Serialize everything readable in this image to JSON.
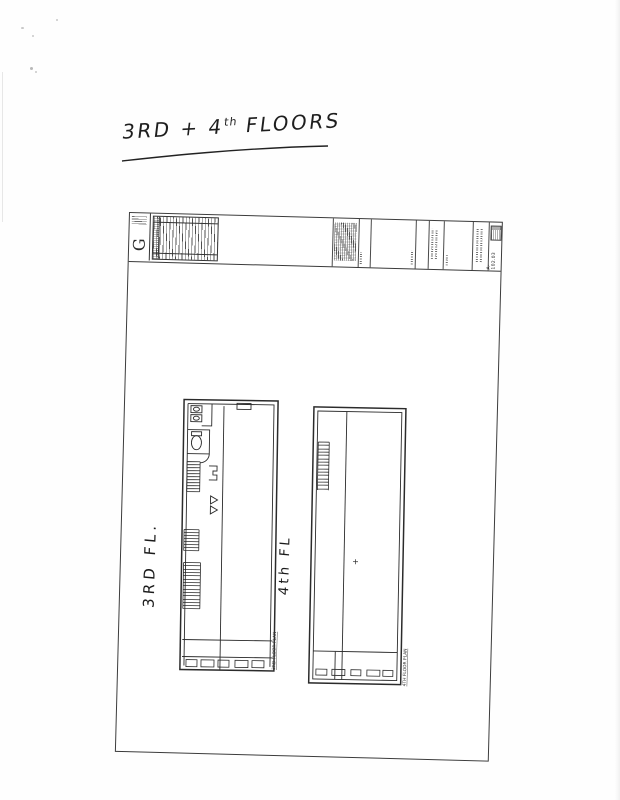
{
  "annotation": {
    "text_main": "3RD + 4",
    "text_sup": "th",
    "text_tail": " FLOORS"
  },
  "handwritten_labels": {
    "left_plan": "3RD FL.",
    "right_plan": "4th FL"
  },
  "title_block": {
    "logo_letter": "G",
    "sheet_number": "A-102.03"
  },
  "plan_captions": {
    "left": "3RD FLOOR PLAN",
    "right": "4TH FLOOR PLAN"
  },
  "colors": {
    "ink": "#222222",
    "line_dark": "#333333",
    "paper": "#ffffff"
  }
}
